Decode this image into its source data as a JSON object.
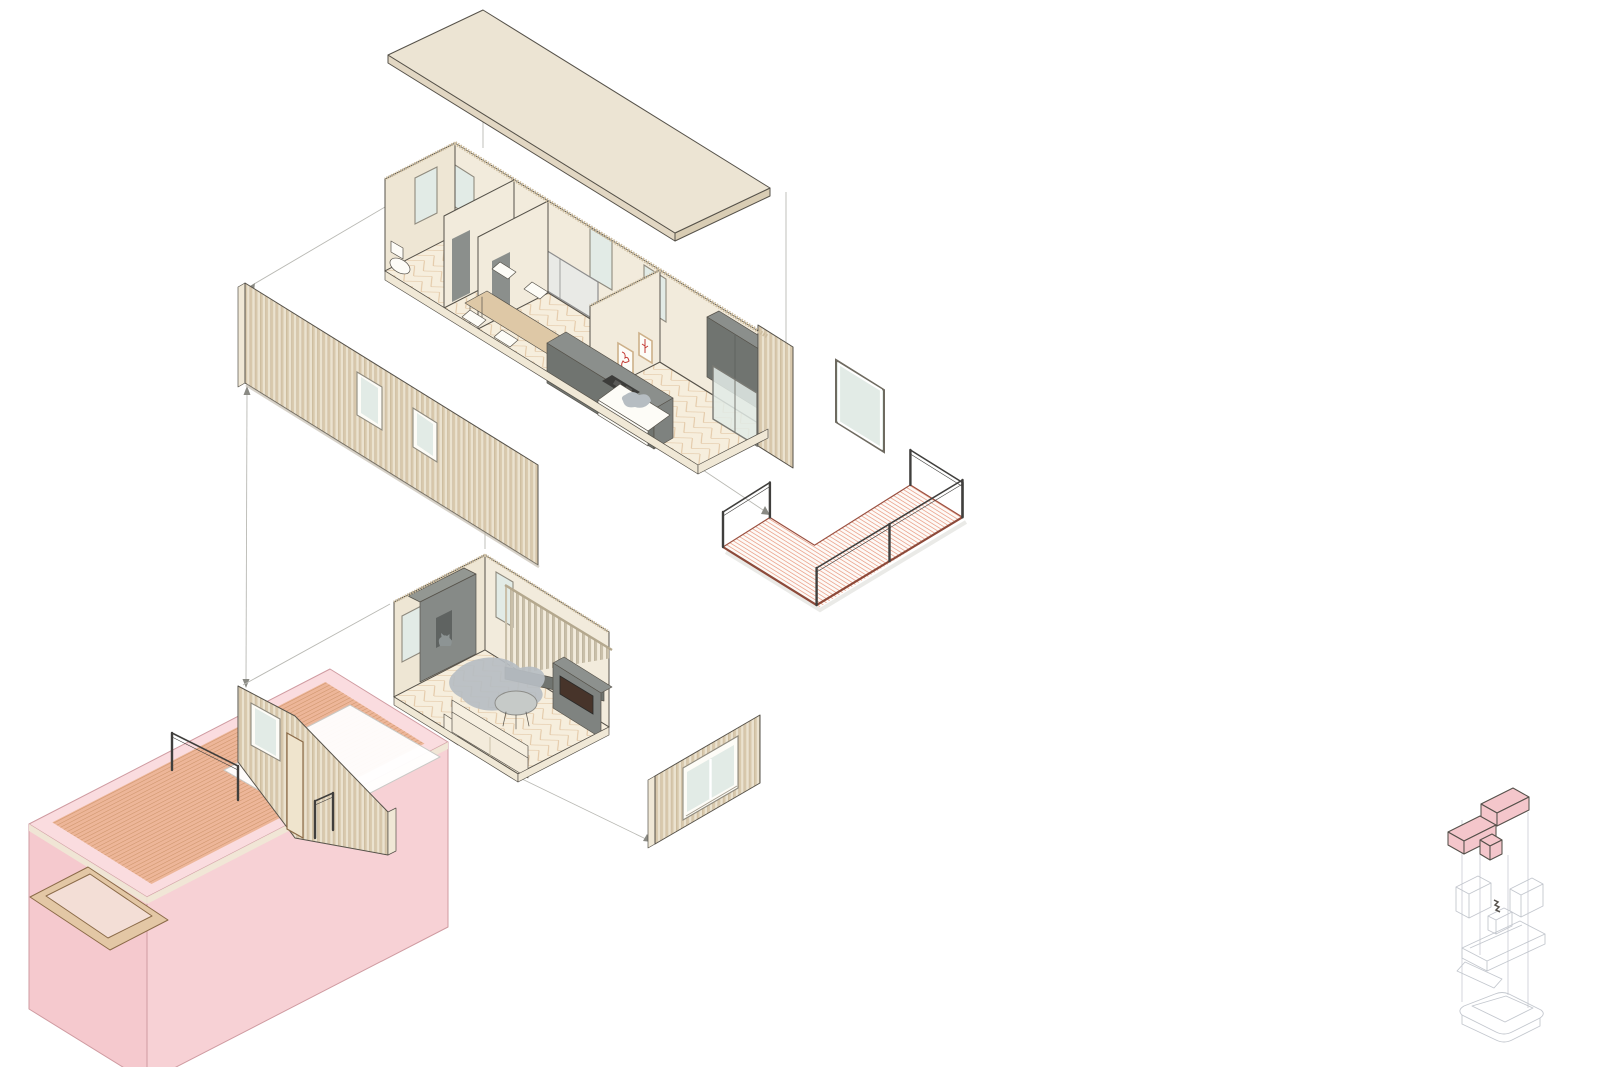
{
  "meta": {
    "title": "Exploded axonometric diagram of a modular timber house",
    "type": "architectural-exploded-axonometric",
    "visible_text": ""
  },
  "components": [
    {
      "id": "roof-panel",
      "label": "roof slab panel"
    },
    {
      "id": "upper-floor-module",
      "label": "upper module: bathroom, dining, kitchen, bedroom"
    },
    {
      "id": "facade-slat-panel",
      "label": "slatted facade panel with two windows"
    },
    {
      "id": "balcony-module",
      "label": "balcony deck with railings"
    },
    {
      "id": "detached-window-panel",
      "label": "detached tall window"
    },
    {
      "id": "living-room-module",
      "label": "living room module with stair screen"
    },
    {
      "id": "window-wall-panel",
      "label": "slatted wall panel with sliding window"
    },
    {
      "id": "base-module-highlighted",
      "label": "highlighted base module with entry deck and stair wall"
    },
    {
      "id": "key-diagram",
      "label": "key stack diagram with highlighted modules"
    },
    {
      "id": "connector-lines",
      "label": "exploded-view alignment lines"
    }
  ],
  "colors": {
    "bg": "#ffffff",
    "line": "#56524a",
    "wall": "#f2ebdc",
    "wall2": "#eee6d4",
    "hatch": "#cdbd9f",
    "roof_top": "#ece4d3",
    "roof_edge": "#e2d7c3",
    "roof_edge2": "#d9cdb4",
    "glass": "#e2ebe6",
    "frame_dark": "#8f8a7e",
    "slat_dark": "#d8c8ac",
    "slat_light": "#ebe2cf",
    "slat_line": "#b9a686",
    "screen_slat": "#c9bfa9",
    "floor_base": "#f6eedd",
    "floor_line": "#d8b288",
    "slab_cream": "#f0e8d6",
    "gray_top": "#8b8f8c",
    "gray_front": "#707470",
    "gray_side": "#7e827f",
    "dark_screen": "#47342a",
    "white_furn": "#fdfcf7",
    "table_tan": "#dec8a6",
    "rug_gray": "#b6bdc2",
    "sofa_cream": "#f6efe0",
    "print_red": "#c43b35",
    "print_frame": "#cdb089",
    "balcony_stripe": "#eba28b",
    "balcony_edge": "#8d4a3a",
    "balcony_back_edge": "#9a5040",
    "railing": "#403f3d",
    "pink_top": "#f8d2d6",
    "pink_mid": "#f5c6cb",
    "pink_deep": "#f3bfc5",
    "pink_edge": "#cf9ba1",
    "deck_orange": "#e7a87e",
    "deck_stripe": "#c98f63",
    "wood_frame": "#e3c7a5",
    "wood_line": "#8a6a48",
    "connector": "#b9b9b4",
    "arrow": "#8a8a84",
    "key_line": "#c3c7ce",
    "key_pink": "#f4c6cb",
    "key_dark": "#55504a",
    "shadow": "#d8d8d4",
    "cat_gray": "#8d9494"
  }
}
